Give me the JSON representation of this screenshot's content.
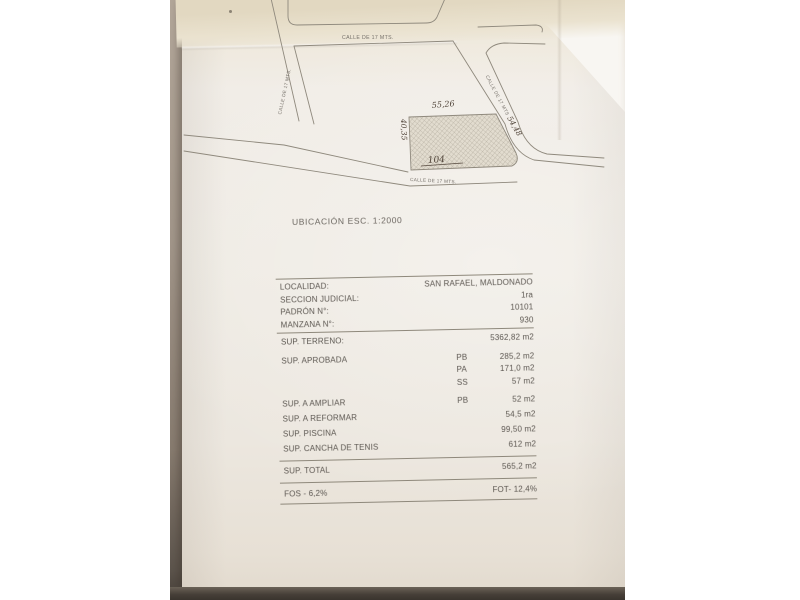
{
  "map": {
    "streets": {
      "top": "CALLE DE 17 MTS.",
      "left": "CALLE DE 17 MTS.",
      "right": "CALLE DE 17 MTS",
      "bottom": "CALLE DE 17 MTS."
    },
    "parcel": {
      "number": "104",
      "dim_top": "55,26",
      "dim_left": "40,35",
      "dim_right": "54,48"
    }
  },
  "caption": "UBICACIÓN ESC. 1:2000",
  "table": {
    "info_rows": [
      {
        "label": "LOCALIDAD:",
        "value": "SAN RAFAEL, MALDONADO"
      },
      {
        "label": "SECCION JUDICIAL:",
        "value": "1ra"
      },
      {
        "label": "PADRÓN N°:",
        "value": "10101"
      },
      {
        "label": "MANZANA N°:",
        "value": "930"
      }
    ],
    "surface_rows": [
      {
        "label": "SUP. TERRENO:",
        "code": "",
        "value": "5362,82 m2"
      },
      {
        "label": "SUP. APROBADA",
        "code": "PB",
        "value": "285,2 m2"
      },
      {
        "label": "",
        "code": "PA",
        "value": "171,0 m2"
      },
      {
        "label": "",
        "code": "SS",
        "value": "57 m2"
      },
      {
        "label": "SUP. A AMPLIAR",
        "code": "PB",
        "value": "52 m2"
      },
      {
        "label": "SUP. A REFORMAR",
        "code": "",
        "value": "54,5 m2"
      },
      {
        "label": "SUP. PISCINA",
        "code": "",
        "value": "99,50 m2"
      },
      {
        "label": "SUP. CANCHA DE TENIS",
        "code": "",
        "value": "612 m2"
      }
    ],
    "total_row": {
      "label": "SUP. TOTAL",
      "value": "565,2 m2"
    },
    "footer_row": {
      "left": "FOS - 6,2%",
      "right": "FOT- 12,4%"
    }
  }
}
